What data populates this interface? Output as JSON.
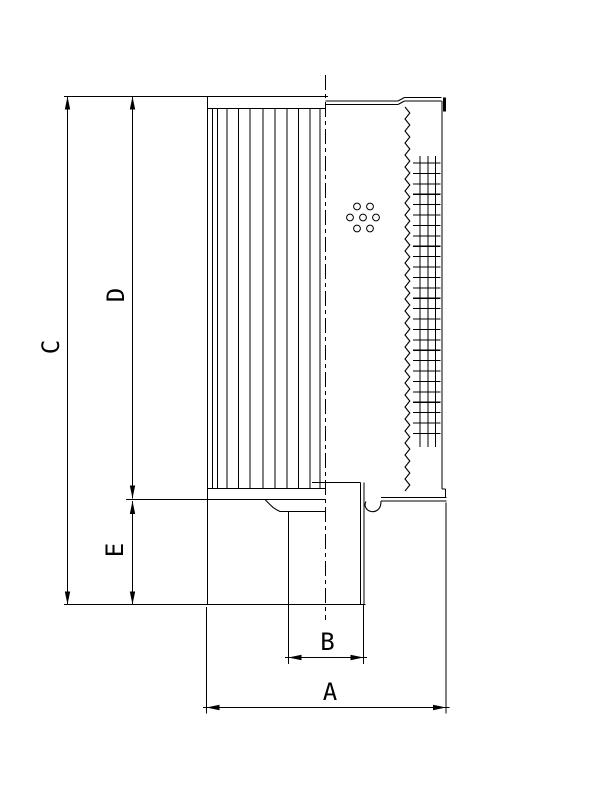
{
  "drawing": {
    "background_color": "#ffffff",
    "line_color": "#000000",
    "dimension_labels": {
      "a": "A",
      "b": "B",
      "c": "C",
      "d": "D",
      "e": "E"
    }
  }
}
